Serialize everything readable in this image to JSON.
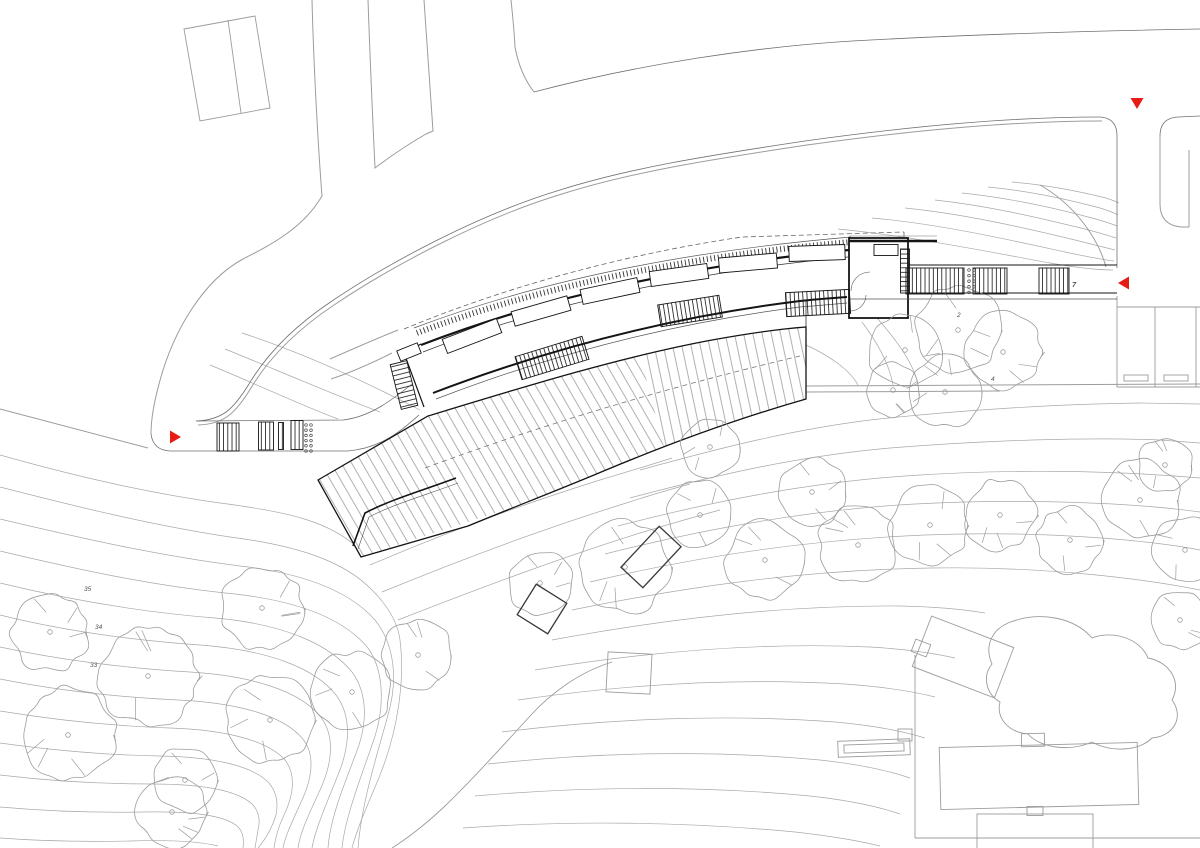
{
  "document": {
    "title": "Site plan – curved pavilion with boardwalk deck",
    "kind": "architectural-site-plan"
  },
  "colors": {
    "paper": "#ffffff",
    "ink": "#141414",
    "mid_gray": "#707070",
    "light_gray": "#9c9c9c",
    "contour_gray": "#a8a8a8",
    "deck_stripe": "#8f8f8f",
    "marker_red": "#e81c16"
  },
  "markers": [
    {
      "name": "section-marker-top",
      "x": 1137,
      "y": 103,
      "dir": "down"
    },
    {
      "name": "section-marker-right",
      "x": 1124,
      "y": 283,
      "dir": "left"
    },
    {
      "name": "section-marker-left",
      "x": 175,
      "y": 437,
      "dir": "right"
    }
  ],
  "annotations": [
    {
      "name": "contour-elevation-label",
      "text": "35",
      "x": 84,
      "y": 591
    },
    {
      "name": "contour-elevation-label",
      "text": "34",
      "x": 95,
      "y": 629
    },
    {
      "name": "contour-elevation-label",
      "text": "33",
      "x": 90,
      "y": 667
    },
    {
      "name": "spot-elevation-label",
      "text": "2",
      "x": 957,
      "y": 317
    },
    {
      "name": "spot-elevation-label",
      "text": "4",
      "x": 991,
      "y": 381
    },
    {
      "name": "stair-number-label",
      "text": "7",
      "x": 1072,
      "y": 287
    }
  ],
  "building": {
    "skylights": [
      {
        "x": 472,
        "y": 336,
        "w": 58,
        "h": 15,
        "rot": -21
      },
      {
        "x": 541,
        "y": 311,
        "w": 58,
        "h": 15,
        "rot": -16
      },
      {
        "x": 610,
        "y": 291,
        "w": 58,
        "h": 15,
        "rot": -12
      },
      {
        "x": 679,
        "y": 275,
        "w": 58,
        "h": 15,
        "rot": -8
      },
      {
        "x": 748,
        "y": 263,
        "w": 58,
        "h": 15,
        "rot": -5
      },
      {
        "x": 817,
        "y": 253,
        "w": 56,
        "h": 15,
        "rot": -2
      },
      {
        "x": 409,
        "y": 352,
        "w": 22,
        "h": 11,
        "rot": -22
      },
      {
        "x": 886,
        "y": 250,
        "w": 24,
        "h": 11,
        "rot": 0
      }
    ],
    "stairs": [
      {
        "x": 552,
        "y": 358,
        "w": 70,
        "h": 24,
        "rot": -17,
        "p": "v"
      },
      {
        "x": 690,
        "y": 311,
        "w": 62,
        "h": 22,
        "rot": -9,
        "p": "v"
      },
      {
        "x": 818,
        "y": 303,
        "w": 64,
        "h": 24,
        "rot": -3,
        "p": "v"
      },
      {
        "x": 404,
        "y": 385,
        "w": 17,
        "h": 46,
        "rot": -14,
        "p": "h"
      },
      {
        "x": 905,
        "y": 271,
        "w": 9,
        "h": 44,
        "rot": 0,
        "p": "h"
      },
      {
        "x": 228,
        "y": 437,
        "w": 22,
        "h": 28,
        "rot": 0,
        "p": "v"
      },
      {
        "x": 266,
        "y": 436,
        "w": 15,
        "h": 28,
        "rot": 0,
        "p": "v"
      },
      {
        "x": 281,
        "y": 436,
        "w": 5,
        "h": 27,
        "rot": 0,
        "p": "v"
      },
      {
        "x": 297,
        "y": 435,
        "w": 12,
        "h": 29,
        "rot": 0,
        "p": "v"
      },
      {
        "x": 935,
        "y": 281,
        "w": 58,
        "h": 26,
        "rot": 0,
        "p": "v"
      },
      {
        "x": 990,
        "y": 281,
        "w": 34,
        "h": 26,
        "rot": 0,
        "p": "v"
      },
      {
        "x": 1054,
        "y": 281,
        "w": 30,
        "h": 26,
        "rot": 0,
        "p": "v"
      }
    ],
    "posts": [
      {
        "x": 306,
        "y": 425,
        "cols": 2,
        "rows": 6,
        "dx": 5,
        "dy": 5.2
      },
      {
        "x": 969,
        "y": 270,
        "cols": 2,
        "rows": 5,
        "dx": 5,
        "dy": 5.6
      }
    ]
  },
  "context": {
    "trees": [
      {
        "x": 50,
        "y": 632,
        "r": 40
      },
      {
        "x": 148,
        "y": 676,
        "r": 50
      },
      {
        "x": 68,
        "y": 735,
        "r": 48
      },
      {
        "x": 185,
        "y": 780,
        "r": 33
      },
      {
        "x": 262,
        "y": 608,
        "r": 42
      },
      {
        "x": 270,
        "y": 720,
        "r": 44
      },
      {
        "x": 172,
        "y": 812,
        "r": 36
      },
      {
        "x": 352,
        "y": 692,
        "r": 40
      },
      {
        "x": 418,
        "y": 655,
        "r": 36
      },
      {
        "x": 540,
        "y": 583,
        "r": 33
      },
      {
        "x": 625,
        "y": 567,
        "r": 46
      },
      {
        "x": 710,
        "y": 447,
        "r": 30
      },
      {
        "x": 812,
        "y": 492,
        "r": 34
      },
      {
        "x": 700,
        "y": 515,
        "r": 34
      },
      {
        "x": 765,
        "y": 560,
        "r": 40
      },
      {
        "x": 858,
        "y": 545,
        "r": 40
      },
      {
        "x": 930,
        "y": 525,
        "r": 40
      },
      {
        "x": 1000,
        "y": 515,
        "r": 36
      },
      {
        "x": 1070,
        "y": 540,
        "r": 34
      },
      {
        "x": 1140,
        "y": 500,
        "r": 40
      },
      {
        "x": 1185,
        "y": 550,
        "r": 34
      },
      {
        "x": 1165,
        "y": 465,
        "r": 28
      },
      {
        "x": 905,
        "y": 350,
        "r": 38
      },
      {
        "x": 958,
        "y": 330,
        "r": 44
      },
      {
        "x": 1003,
        "y": 352,
        "r": 40
      },
      {
        "x": 945,
        "y": 392,
        "r": 36
      },
      {
        "x": 893,
        "y": 390,
        "r": 28
      },
      {
        "x": 1180,
        "y": 620,
        "r": 30
      }
    ],
    "outline_rects": [
      {
        "x": 542,
        "y": 609,
        "w": 36,
        "h": 36,
        "rot": 32,
        "tone": "dark"
      },
      {
        "x": 651,
        "y": 557,
        "w": 30,
        "h": 56,
        "rot": 43,
        "tone": "dark"
      },
      {
        "x": 629,
        "y": 673,
        "w": 44,
        "h": 40,
        "rot": 3,
        "tone": "mid"
      },
      {
        "x": 963,
        "y": 657,
        "w": 88,
        "h": 54,
        "rot": 21,
        "tone": "mid"
      },
      {
        "x": 921,
        "y": 648,
        "w": 16,
        "h": 13,
        "rot": 21,
        "tone": "mid"
      },
      {
        "x": 1039,
        "y": 776,
        "w": 198,
        "h": 62,
        "rot": -1.5,
        "tone": "mid"
      },
      {
        "x": 1033,
        "y": 740,
        "w": 23,
        "h": 13,
        "rot": -1.5,
        "tone": "mid"
      },
      {
        "x": 1035,
        "y": 833,
        "w": 116,
        "h": 38,
        "rot": 0,
        "tone": "mid"
      },
      {
        "x": 1035,
        "y": 811,
        "w": 16,
        "h": 9,
        "rot": 0,
        "tone": "mid"
      },
      {
        "x": 874,
        "y": 748,
        "w": 72,
        "h": 16,
        "rot": -2,
        "tone": "mid"
      },
      {
        "x": 874,
        "y": 748,
        "w": 60,
        "h": 8,
        "rot": -2,
        "tone": "mid"
      },
      {
        "x": 905,
        "y": 735,
        "w": 14,
        "h": 12,
        "rot": 0,
        "tone": "mid"
      },
      {
        "x": 1136,
        "y": 378,
        "w": 24,
        "h": 6,
        "rot": 0,
        "tone": "mid"
      },
      {
        "x": 1176,
        "y": 378,
        "w": 24,
        "h": 6,
        "rot": 0,
        "tone": "mid"
      }
    ]
  }
}
